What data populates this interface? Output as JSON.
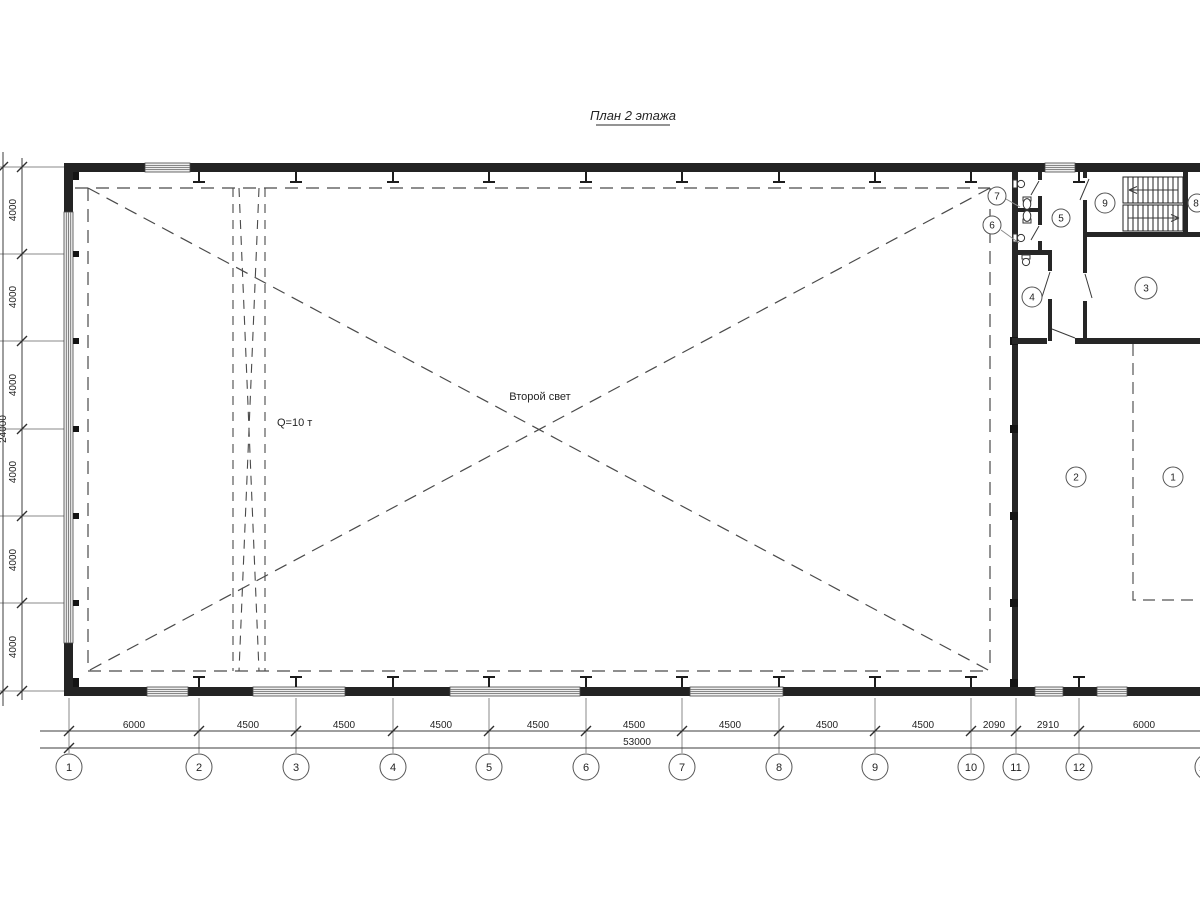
{
  "title": "План 2 этажа",
  "hall": {
    "void_label": "Второй свет",
    "crane_label": "Q=10 т"
  },
  "grid": {
    "bottom_bubbles": [
      "1",
      "2",
      "3",
      "4",
      "5",
      "6",
      "7",
      "8",
      "9",
      "10",
      "11",
      "12",
      "13"
    ],
    "bottom_dims": [
      "6000",
      "4500",
      "4500",
      "4500",
      "4500",
      "4500",
      "4500",
      "4500",
      "4500",
      "2090",
      "2910",
      "6000"
    ],
    "bottom_total": "53000",
    "left_dims": [
      "4000",
      "4000",
      "4000",
      "4000",
      "4000",
      "4000"
    ],
    "left_total": "24000"
  },
  "rooms": {
    "numbers": [
      "1",
      "2",
      "3",
      "4",
      "5",
      "6",
      "7",
      "8",
      "9"
    ]
  }
}
